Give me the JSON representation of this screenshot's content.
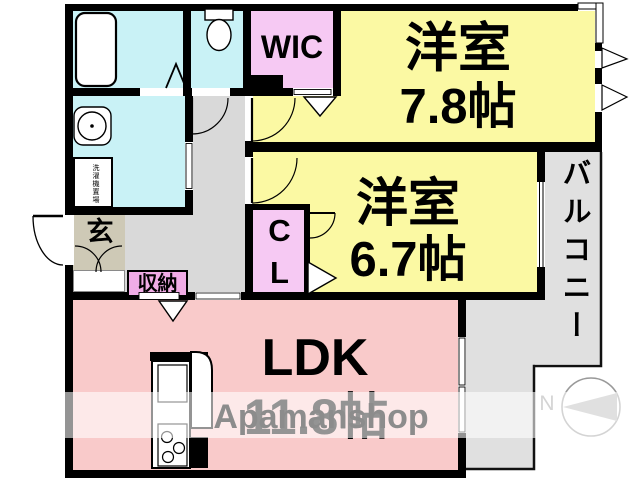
{
  "floorplan": {
    "rooms": {
      "bedroom1": {
        "name": "洋室",
        "size": "7.8帖"
      },
      "bedroom2": {
        "name": "洋室",
        "size": "6.7帖"
      },
      "ldk": {
        "name": "LDK",
        "size": "11.8帖"
      },
      "wic": {
        "label": "WIC"
      },
      "closet": {
        "label": "CL"
      },
      "entrance": {
        "label": "玄"
      },
      "storage": {
        "label": "収納"
      },
      "balcony": {
        "label": "バルコニー"
      },
      "laundry": {
        "label": "洗濯機置場"
      }
    },
    "compass": {
      "north_label": "N"
    },
    "watermark": {
      "text": "Apamanshop"
    },
    "colors": {
      "room_yellow": "#fbf9a3",
      "room_cyan": "#c9f2f6",
      "room_pink_wic_cl": "#f6c9f3",
      "room_pink_storage": "#f0ace6",
      "room_pink_ldk": "#f9caca",
      "hall_gray": "#d9d9d9",
      "balcony_gray": "#e0e0e0",
      "entrance_beige": "#cec9b6",
      "wall_black": "#000000",
      "watermark_gray": "#8c8c8c"
    }
  }
}
